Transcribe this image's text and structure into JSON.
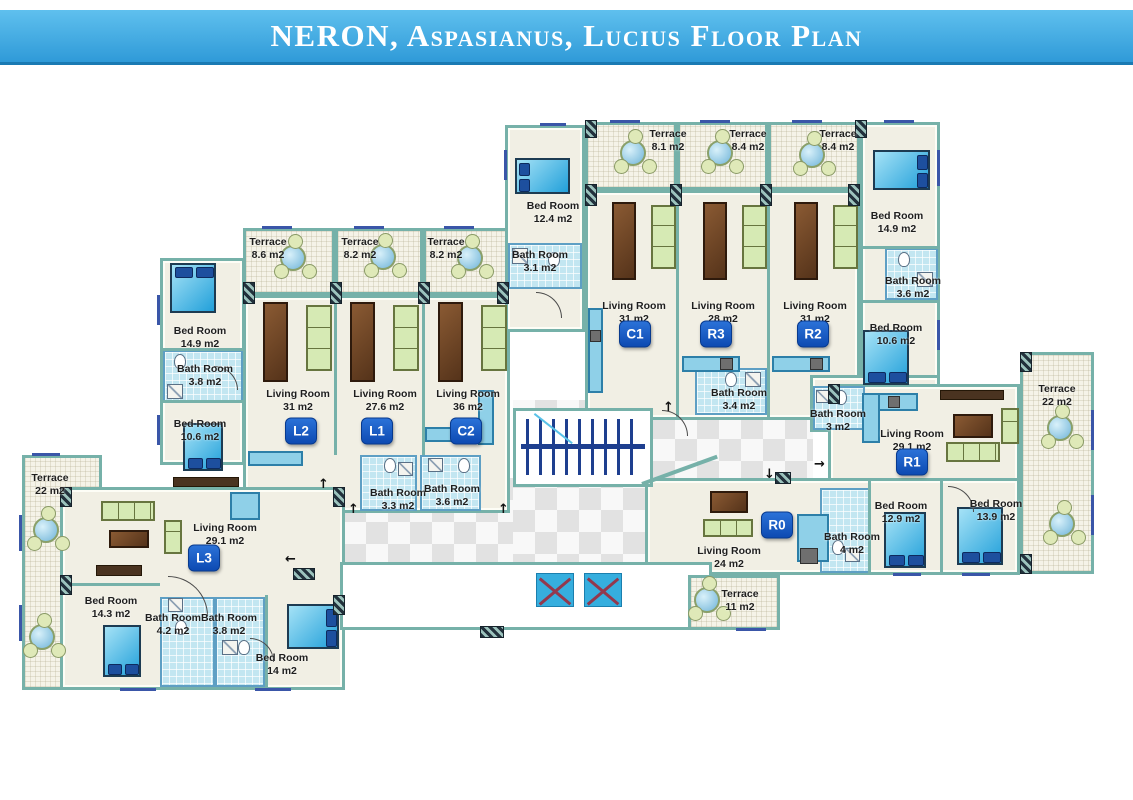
{
  "header": {
    "title": "NERON, Aspasianus, Lucius Floor Plan"
  },
  "units": [
    {
      "code": "L1"
    },
    {
      "code": "L2"
    },
    {
      "code": "L3"
    },
    {
      "code": "C1"
    },
    {
      "code": "C2"
    },
    {
      "code": "R0"
    },
    {
      "code": "R1"
    },
    {
      "code": "R2"
    },
    {
      "code": "R3"
    }
  ],
  "rooms": [
    {
      "name": "Terrace",
      "area": "8.1 m2"
    },
    {
      "name": "Terrace",
      "area": "8.4 m2"
    },
    {
      "name": "Terrace",
      "area": "8.4 m2"
    },
    {
      "name": "Bed Room",
      "area": "12.4 m2"
    },
    {
      "name": "Bath Room",
      "area": "3.1 m2"
    },
    {
      "name": "Bed Room",
      "area": "14.9 m2"
    },
    {
      "name": "Bath Room",
      "area": "3.6 m2"
    },
    {
      "name": "Bed Room",
      "area": "10.6 m2"
    },
    {
      "name": "Living Room",
      "area": "31 m2"
    },
    {
      "name": "Living Room",
      "area": "28 m2"
    },
    {
      "name": "Living Room",
      "area": "31 m2"
    },
    {
      "name": "Terrace",
      "area": "8.6 m2"
    },
    {
      "name": "Terrace",
      "area": "8.2 m2"
    },
    {
      "name": "Terrace",
      "area": "8.2 m2"
    },
    {
      "name": "Bed Room",
      "area": "14.9 m2"
    },
    {
      "name": "Bath Room",
      "area": "3.8 m2"
    },
    {
      "name": "Bed Room",
      "area": "10.6 m2"
    },
    {
      "name": "Living Room",
      "area": "31 m2"
    },
    {
      "name": "Living Room",
      "area": "27.6 m2"
    },
    {
      "name": "Living Room",
      "area": "36 m2"
    },
    {
      "name": "Bath Room",
      "area": "3.3 m2"
    },
    {
      "name": "Bath Room",
      "area": "3.6 m2"
    },
    {
      "name": "Bath Room",
      "area": "3.4 m2"
    },
    {
      "name": "Bath Room",
      "area": "3 m2"
    },
    {
      "name": "Living Room",
      "area": "29.1 m2"
    },
    {
      "name": "Terrace",
      "area": "22 m2"
    },
    {
      "name": "Living Room",
      "area": "24 m2"
    },
    {
      "name": "Bath Room",
      "area": "4 m2"
    },
    {
      "name": "Bed Room",
      "area": "12.9 m2"
    },
    {
      "name": "Bed Room",
      "area": "13.9 m2"
    },
    {
      "name": "Terrace",
      "area": "11 m2"
    },
    {
      "name": "Terrace",
      "area": "22 m2"
    },
    {
      "name": "Living Room",
      "area": "29.1 m2"
    },
    {
      "name": "Bed Room",
      "area": "14.3 m2"
    },
    {
      "name": "Bath Room",
      "area": "4.2 m2"
    },
    {
      "name": "Bath Room",
      "area": "3.8 m2"
    },
    {
      "name": "Bed Room",
      "area": "14 m2"
    }
  ],
  "icons": {
    "stairs-icon": "striped stair treads with center rail",
    "elevator-x-icon": "blue square with crossed diagonals",
    "terrace-table-icon": "round table with three chairs",
    "bed-icon": "blue double bed with pillows",
    "sofa-icon": "green segmented sofa",
    "table-icon": "brown coffee table",
    "kitchen-counter-icon": "light blue counter",
    "toilet-icon": "white oval toilet",
    "shower-icon": "square with diagonal"
  },
  "colors": {
    "banner": "#3fa9e1",
    "wall": "#76b1a9",
    "floor": "#f1efe4",
    "bath_tile": "#c2e6f1",
    "bed": "#22a0da",
    "sofa": "#d6eab4",
    "badge": "#0d4ab2",
    "elevator": "#36aede",
    "stairs": "#1e3f8f",
    "checker_light": "#f8f8f8",
    "checker_dark": "#e2e2e2"
  }
}
